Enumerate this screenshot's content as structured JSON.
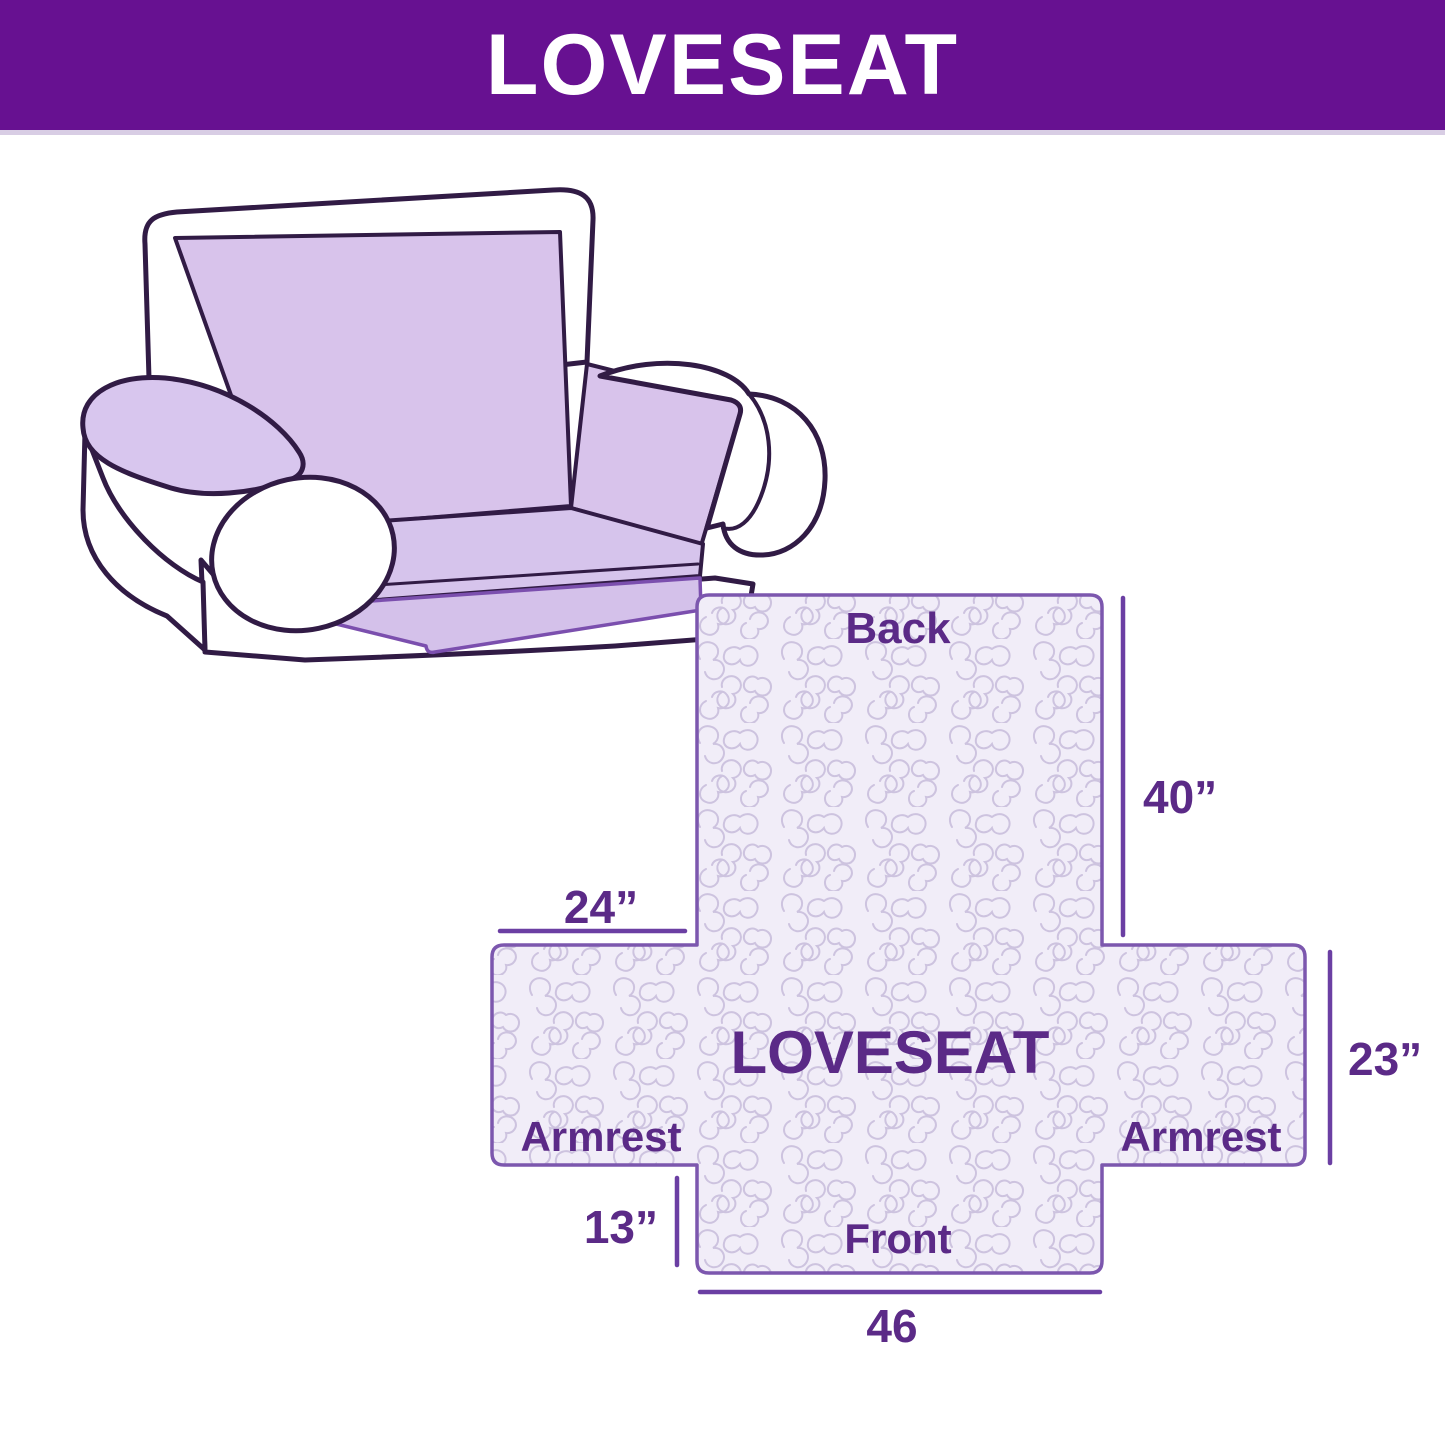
{
  "header": {
    "title": "LOVESEAT"
  },
  "illustration": {
    "alt": "loveseat sofa with light purple slipcover"
  },
  "diagram": {
    "center_label": "LOVESEAT",
    "back_label": "Back",
    "front_label": "Front",
    "armrest_left_label": "Armrest",
    "armrest_right_label": "Armrest",
    "dim_back_height": "40”",
    "dim_side_width": "24”",
    "dim_armrest_height": "23”",
    "dim_front_drop": "13”",
    "dim_front_width": "46"
  },
  "colors": {
    "header_bg": "#671191",
    "header_text": "#FFFFFF",
    "label_text": "#5B2A87",
    "dimension_line": "#6B3FA3",
    "shape_outline": "#7C57AE",
    "quilt_bg": "#F1EDF8",
    "quilt_line": "#CDC3DF",
    "sofa_outline": "#311B45",
    "cover_lilac": "#D8C3EB"
  }
}
